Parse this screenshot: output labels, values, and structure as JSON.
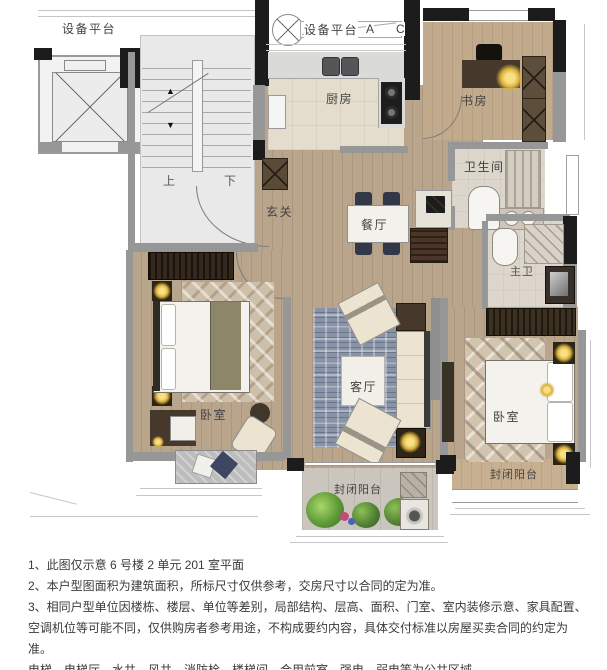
{
  "plan": {
    "labels": {
      "equipment_platform_left": "设备平台",
      "equipment_platform_top": "设备平台",
      "marker_a": "A",
      "marker_c": "C",
      "kitchen": "厨房",
      "study": "书房",
      "bathroom": "卫生间",
      "entry": "玄关",
      "dining": "餐厅",
      "master_bath": "主卫",
      "living": "客厅",
      "bedroom_left": "卧室",
      "bedroom_right": "卧室",
      "balcony_bottom": "封闭阳台",
      "balcony_right": "封闭阳台",
      "stairs_up": "上",
      "stairs_down": "下",
      "arrow_up": "▲",
      "arrow_down": "▼"
    },
    "colors": {
      "wall_black": "#1c1c1c",
      "wall_gray": "#979797",
      "wood_floor": "#b9a48c",
      "living_rug": "#8893a7",
      "lamp_gold": "#e8c35c",
      "plant_green": "#5a8f3c"
    }
  },
  "notes": {
    "line1": "1、此图仅示意 6 号楼 2 单元 201 室平面",
    "line2": "2、本户型图面积为建筑面积，所标尺寸仅供参考，交房尺寸以合同的定为准。",
    "line3": "3、相同户型单位因楼栋、楼层、单位等差别，局部结构、层高、面积、门室、室内装修示意、家具配置、",
    "line4": "空调机位等可能不同，仅供购房者参考用途，不构成要约内容，具体交付标准以房屋买卖合同的约定为准。",
    "line5": "电梯、电梯厅、水井、风井、消防栓、楼梯间、合用前室、强电、弱电等为公共区域。"
  }
}
